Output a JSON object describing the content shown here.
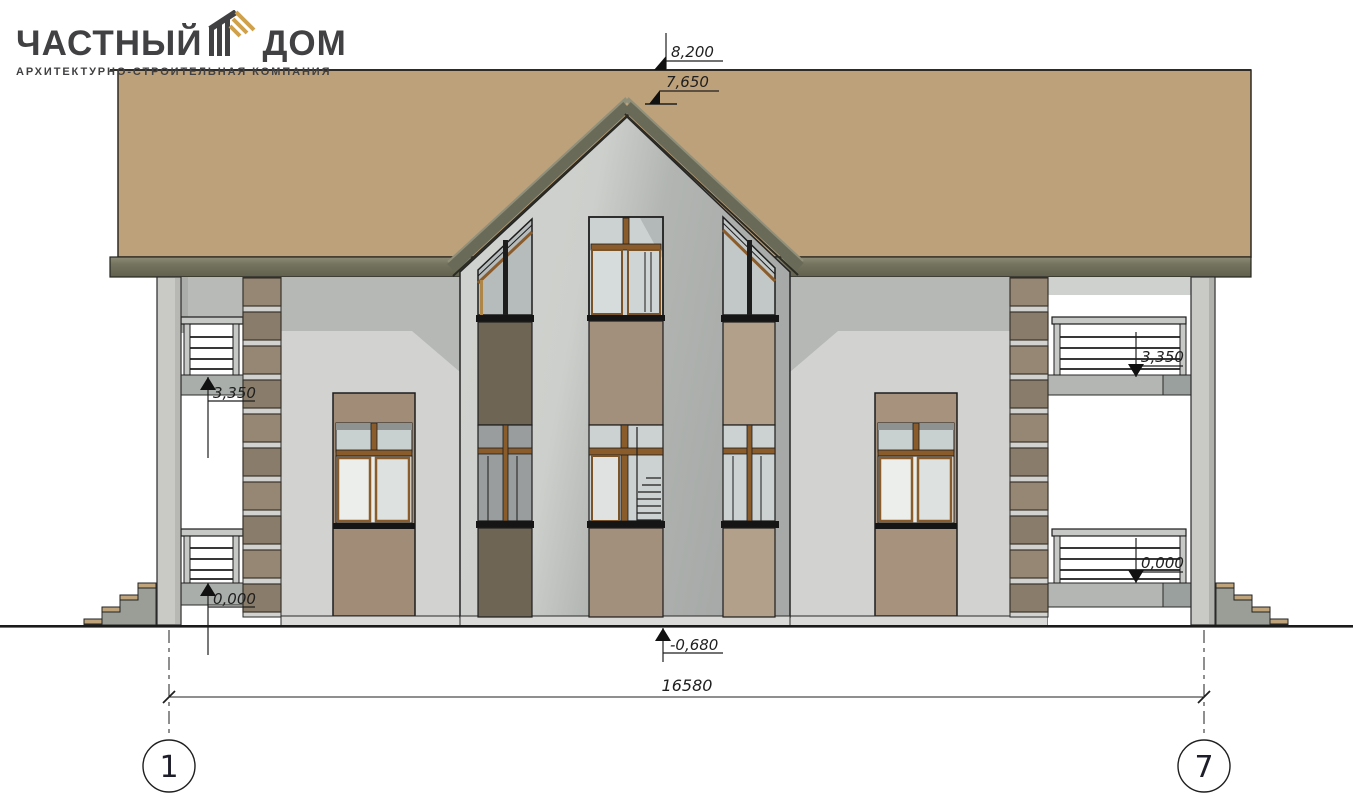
{
  "logo": {
    "title_left": "ЧАСТНЫЙ",
    "title_right": "ДОМ",
    "subtitle": "АРХИТЕКТУРНО-СТРОИТЕЛЬНАЯ КОМПАНИЯ"
  },
  "drawing": {
    "type": "house front elevation",
    "annotations": {
      "ridge_level": "8,200",
      "gable_peak_level": "7,650",
      "second_floor_left": "3,350",
      "second_floor_right": "3,350",
      "ground_floor_left": "0,000",
      "ground_floor_right": "0,000",
      "terrain_level": "-0,680",
      "overall_width_mm": "16580"
    },
    "axes": {
      "left": "1",
      "right": "7"
    }
  },
  "colors": {
    "roof": "#bda17b",
    "fascia": "#6c6c59",
    "wall": "#d2d3d0",
    "wall_shadow": "#b5b8b5",
    "wood_accent": "#8a5c2c",
    "spandrel_dark": "#6f6555",
    "spandrel_tan": "#a3907c",
    "quoin": "#8e8070",
    "logo_dark": "#414143",
    "logo_gold": "#cfa14b"
  }
}
